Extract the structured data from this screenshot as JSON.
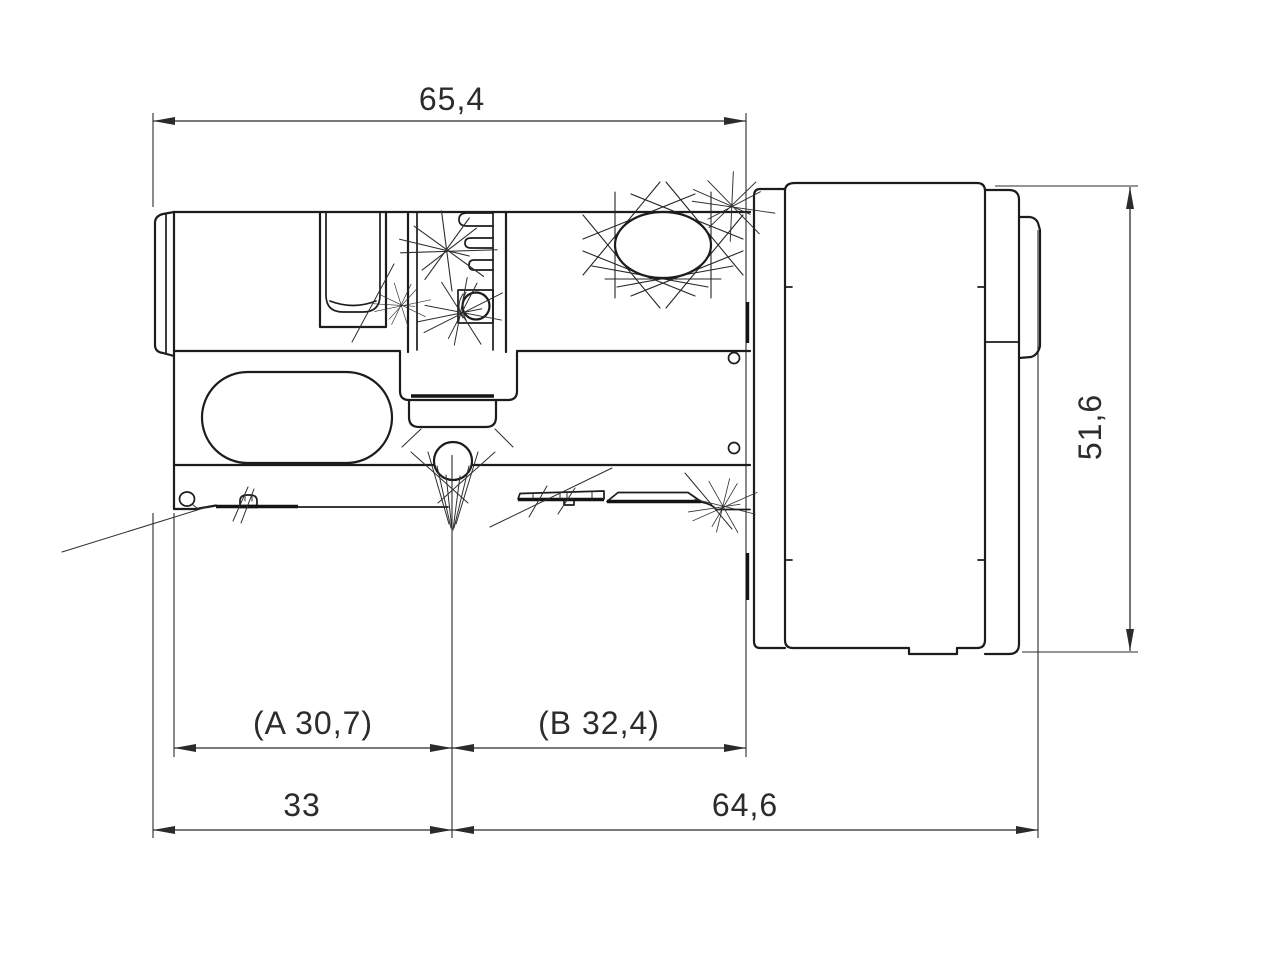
{
  "drawing": {
    "background_color": "#ffffff",
    "line_color": "#1c1c1c",
    "dimension_color": "#2b2b2b",
    "dimensions": {
      "top_overall_width": "65,4",
      "right_overall_height": "51,6",
      "a_half_length": "(A 30,7)",
      "b_half_length": "(B 32,4)",
      "bottom_left_length": "33",
      "bottom_right_length": "64,6"
    }
  }
}
